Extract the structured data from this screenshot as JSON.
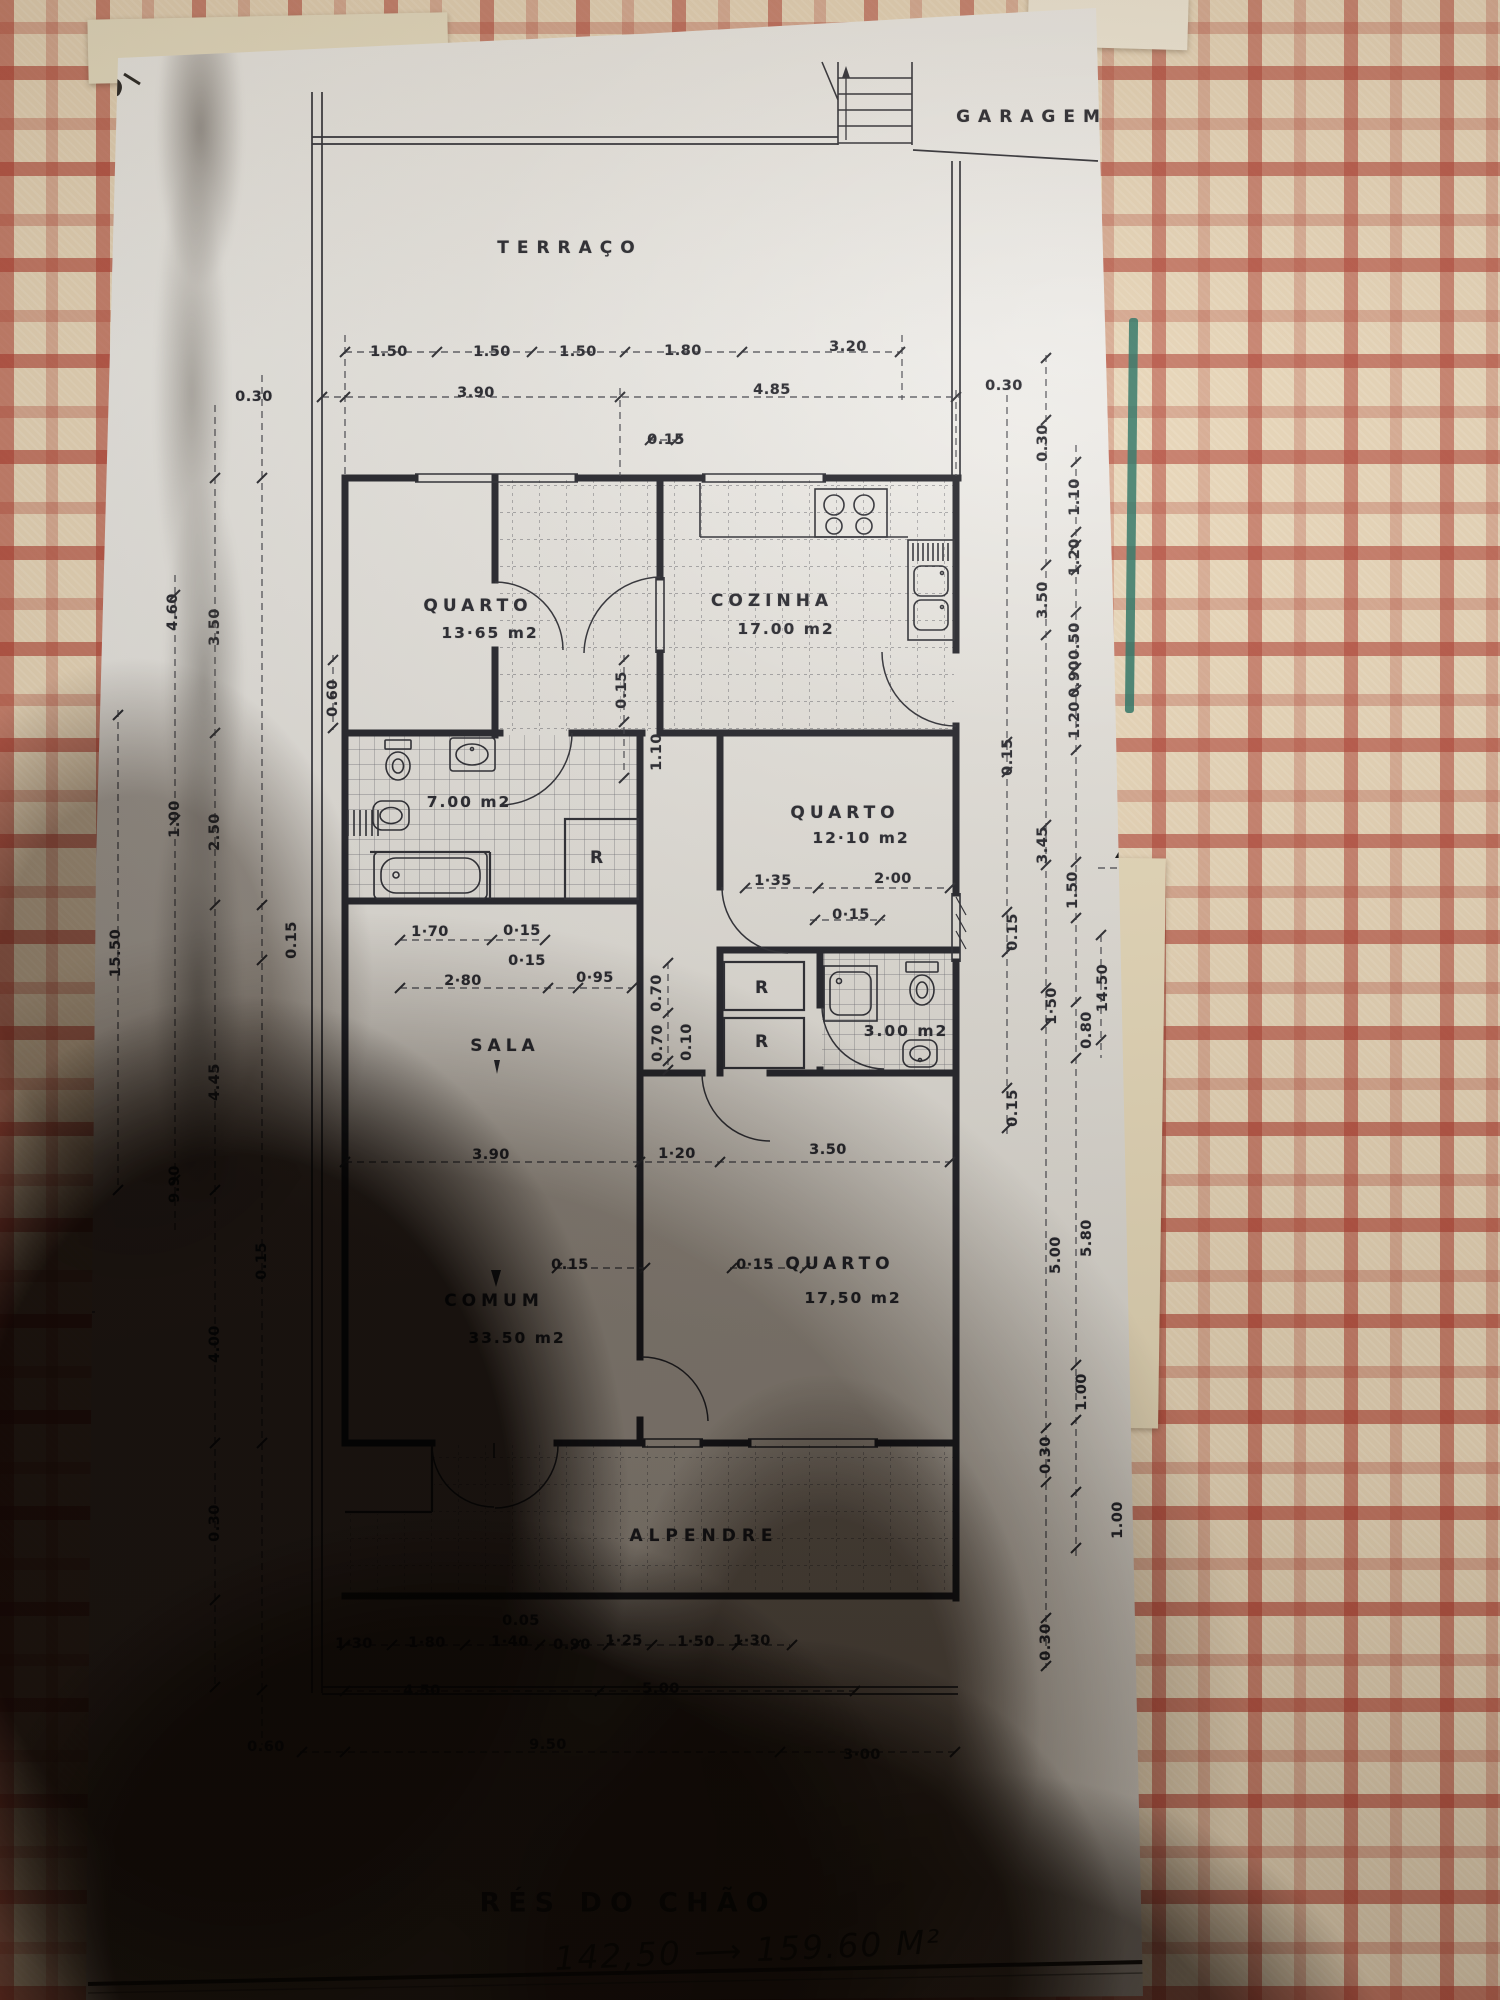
{
  "title_block": {
    "floor_label": "RÉS  DO CHÃO",
    "handwritten_note": "142,50 ⟶ 159.60 M²"
  },
  "plan": {
    "labels": [
      {
        "name": "garage-label",
        "text": "GARAGEM",
        "x": 1032,
        "y": 117,
        "cls": "room",
        "ls": 8
      },
      {
        "name": "terrace-label",
        "text": "TERRAÇO",
        "x": 570,
        "y": 248,
        "cls": "room",
        "ls": 8
      },
      {
        "name": "dim",
        "text": "1.50",
        "x": 389,
        "y": 352
      },
      {
        "name": "dim",
        "text": "1.50",
        "x": 492,
        "y": 352
      },
      {
        "name": "dim",
        "text": "1.50",
        "x": 578,
        "y": 352
      },
      {
        "name": "dim",
        "text": "1.80",
        "x": 683,
        "y": 351
      },
      {
        "name": "dim",
        "text": "3.20",
        "x": 848,
        "y": 347
      },
      {
        "name": "dim",
        "text": "0.30",
        "x": 254,
        "y": 397
      },
      {
        "name": "dim",
        "text": "3.90",
        "x": 476,
        "y": 393
      },
      {
        "name": "dim",
        "text": "4.85",
        "x": 772,
        "y": 390
      },
      {
        "name": "dim",
        "text": "0.30",
        "x": 1004,
        "y": 386
      },
      {
        "name": "dim",
        "text": "0.15",
        "x": 666,
        "y": 440
      },
      {
        "name": "room-label-quarto-1",
        "text": "QUARTO",
        "x": 478,
        "y": 606,
        "cls": "room"
      },
      {
        "name": "room-area-quarto-1",
        "text": "13·65 m2",
        "x": 490,
        "y": 633,
        "cls": "area"
      },
      {
        "name": "room-label-cozinha",
        "text": "COZINHA",
        "x": 772,
        "y": 601,
        "cls": "room"
      },
      {
        "name": "room-area-cozinha",
        "text": "17.00 m2",
        "x": 786,
        "y": 629,
        "cls": "area"
      },
      {
        "name": "dim",
        "text": "0.60",
        "x": 333,
        "y": 698,
        "rot": -90
      },
      {
        "name": "dim",
        "text": "0.15",
        "x": 622,
        "y": 690,
        "rot": -90
      },
      {
        "name": "dim",
        "text": "1.10",
        "x": 657,
        "y": 752,
        "rot": -90
      },
      {
        "name": "room-area-banho",
        "text": "7.00 m2",
        "x": 469,
        "y": 802,
        "cls": "area"
      },
      {
        "name": "room-label-quarto-2",
        "text": "QUARTO",
        "x": 845,
        "y": 813,
        "cls": "room"
      },
      {
        "name": "room-area-quarto-2",
        "text": "12·10 m2",
        "x": 861,
        "y": 838,
        "cls": "area"
      },
      {
        "name": "closet-label-r1",
        "text": "R",
        "x": 599,
        "y": 858,
        "cls": "room"
      },
      {
        "name": "dim",
        "text": "1·70",
        "x": 430,
        "y": 932
      },
      {
        "name": "dim",
        "text": "0·15",
        "x": 522,
        "y": 931
      },
      {
        "name": "dim",
        "text": "0·15",
        "x": 527,
        "y": 961
      },
      {
        "name": "dim",
        "text": "2·80",
        "x": 463,
        "y": 981
      },
      {
        "name": "dim",
        "text": "0·95",
        "x": 595,
        "y": 978
      },
      {
        "name": "dim",
        "text": "1·35",
        "x": 773,
        "y": 881
      },
      {
        "name": "dim",
        "text": "2·00",
        "x": 893,
        "y": 879
      },
      {
        "name": "dim",
        "text": "0·15",
        "x": 851,
        "y": 915
      },
      {
        "name": "dim",
        "text": "0.15",
        "x": 1013,
        "y": 932,
        "rot": -90
      },
      {
        "name": "dim",
        "text": "1·50",
        "x": 1052,
        "y": 1006,
        "rot": -90
      },
      {
        "name": "closet-label-r2",
        "text": "R",
        "x": 764,
        "y": 988,
        "cls": "room"
      },
      {
        "name": "closet-label-r3",
        "text": "R",
        "x": 764,
        "y": 1042,
        "cls": "room"
      },
      {
        "name": "room-area-wc",
        "text": "3.00 m2",
        "x": 906,
        "y": 1031,
        "cls": "area"
      },
      {
        "name": "dim",
        "text": "0.70",
        "x": 657,
        "y": 993,
        "rot": -90
      },
      {
        "name": "dim",
        "text": "0.70",
        "x": 658,
        "y": 1043,
        "rot": -90
      },
      {
        "name": "dim",
        "text": "0.10",
        "x": 687,
        "y": 1042,
        "rot": -90
      },
      {
        "name": "room-label-sala",
        "text": "SALA",
        "x": 505,
        "y": 1046,
        "cls": "room"
      },
      {
        "name": "dim",
        "text": "0.15",
        "x": 1013,
        "y": 1108,
        "rot": -90
      },
      {
        "name": "dim",
        "text": "3.90",
        "x": 491,
        "y": 1155
      },
      {
        "name": "dim",
        "text": "1·20",
        "x": 677,
        "y": 1154
      },
      {
        "name": "dim",
        "text": "3.50",
        "x": 828,
        "y": 1150
      },
      {
        "name": "dim",
        "text": "0.15",
        "x": 570,
        "y": 1265
      },
      {
        "name": "dim",
        "text": "0·15",
        "x": 755,
        "y": 1265
      },
      {
        "name": "room-label-quarto-3",
        "text": "QUARTO",
        "x": 840,
        "y": 1264,
        "cls": "room"
      },
      {
        "name": "room-area-quarto-3",
        "text": "17,50 m2",
        "x": 853,
        "y": 1298,
        "cls": "area"
      },
      {
        "name": "room-label-comum",
        "text": "COMUM",
        "x": 494,
        "y": 1301,
        "cls": "room"
      },
      {
        "name": "room-area-comum",
        "text": "33.50 m2",
        "x": 517,
        "y": 1338,
        "cls": "area"
      },
      {
        "name": "porch-label",
        "text": "ALPENDRE",
        "x": 704,
        "y": 1536,
        "cls": "room",
        "ls": 6
      },
      {
        "name": "dim",
        "text": "0.05",
        "x": 521,
        "y": 1621
      },
      {
        "name": "dim",
        "text": "1·30",
        "x": 354,
        "y": 1644
      },
      {
        "name": "dim",
        "text": "1·80",
        "x": 427,
        "y": 1643
      },
      {
        "name": "dim",
        "text": "1·40",
        "x": 510,
        "y": 1642
      },
      {
        "name": "dim",
        "text": "0.90",
        "x": 572,
        "y": 1645
      },
      {
        "name": "dim",
        "text": "1·25",
        "x": 624,
        "y": 1641
      },
      {
        "name": "dim",
        "text": "1·50",
        "x": 696,
        "y": 1642
      },
      {
        "name": "dim",
        "text": "1·30",
        "x": 752,
        "y": 1641
      },
      {
        "name": "dim",
        "text": "4.50",
        "x": 422,
        "y": 1691
      },
      {
        "name": "dim",
        "text": "5.00",
        "x": 661,
        "y": 1689
      },
      {
        "name": "dim",
        "text": "0.60",
        "x": 266,
        "y": 1747
      },
      {
        "name": "dim",
        "text": "9.50",
        "x": 548,
        "y": 1745
      },
      {
        "name": "dim",
        "text": "3·00",
        "x": 862,
        "y": 1755
      },
      {
        "name": "dim",
        "text": "4.60",
        "x": 173,
        "y": 612,
        "rot": -90
      },
      {
        "name": "dim",
        "text": "3.50",
        "x": 215,
        "y": 627,
        "rot": -90
      },
      {
        "name": "dim",
        "text": "1.00",
        "x": 175,
        "y": 819,
        "rot": -90
      },
      {
        "name": "dim",
        "text": "2.50",
        "x": 215,
        "y": 832,
        "rot": -90
      },
      {
        "name": "dim",
        "text": "0.15",
        "x": 292,
        "y": 940,
        "rot": -90
      },
      {
        "name": "dim",
        "text": "15.50",
        "x": 116,
        "y": 953,
        "rot": -90
      },
      {
        "name": "dim",
        "text": "4.45",
        "x": 215,
        "y": 1082,
        "rot": -90
      },
      {
        "name": "dim",
        "text": "9.90",
        "x": 175,
        "y": 1184,
        "rot": -90
      },
      {
        "name": "dim",
        "text": "0.15",
        "x": 262,
        "y": 1261,
        "rot": -90
      },
      {
        "name": "dim",
        "text": "4.00",
        "x": 215,
        "y": 1344,
        "rot": -90
      },
      {
        "name": "dim",
        "text": "0.30",
        "x": 215,
        "y": 1523,
        "rot": -90
      },
      {
        "name": "dim",
        "text": "0.30",
        "x": 1043,
        "y": 443,
        "rot": -90
      },
      {
        "name": "dim",
        "text": "1.10",
        "x": 1075,
        "y": 497,
        "rot": -90
      },
      {
        "name": "dim",
        "text": "1.20",
        "x": 1075,
        "y": 557,
        "rot": -90
      },
      {
        "name": "dim",
        "text": "3.50",
        "x": 1043,
        "y": 600,
        "rot": -90
      },
      {
        "name": "dim",
        "text": "0.50",
        "x": 1075,
        "y": 641,
        "rot": -90
      },
      {
        "name": "dim",
        "text": "0.90",
        "x": 1075,
        "y": 679,
        "rot": -90
      },
      {
        "name": "dim",
        "text": "1.20",
        "x": 1075,
        "y": 720,
        "rot": -90
      },
      {
        "name": "dim",
        "text": "0.15",
        "x": 1008,
        "y": 757,
        "rot": -90
      },
      {
        "name": "dim",
        "text": "3.45",
        "x": 1043,
        "y": 845,
        "rot": -90
      },
      {
        "name": "dim",
        "text": "1.50",
        "x": 1073,
        "y": 890,
        "rot": -90
      },
      {
        "name": "dim",
        "text": "0.80",
        "x": 1087,
        "y": 1030,
        "rot": -90
      },
      {
        "name": "dim",
        "text": "5.00",
        "x": 1056,
        "y": 1255,
        "rot": -90
      },
      {
        "name": "dim",
        "text": "5.80",
        "x": 1087,
        "y": 1238,
        "rot": -90
      },
      {
        "name": "dim",
        "text": "14.50",
        "x": 1103,
        "y": 988,
        "rot": -90
      },
      {
        "name": "serventia-label",
        "text": "SERVENTIA",
        "x": 1134,
        "y": 1088,
        "rot": -90,
        "cls": "room",
        "ls": 3
      },
      {
        "name": "dim",
        "text": "1.00",
        "x": 1082,
        "y": 1392,
        "rot": -90
      },
      {
        "name": "dim",
        "text": "0.30",
        "x": 1046,
        "y": 1455,
        "rot": -90
      },
      {
        "name": "dim",
        "text": "1.00",
        "x": 1118,
        "y": 1520,
        "rot": -90
      },
      {
        "name": "dim",
        "text": "0.30",
        "x": 1046,
        "y": 1642,
        "rot": -90
      },
      {
        "name": "section-marker-c",
        "text": "C",
        "x": 43,
        "y": 1333,
        "cls": "marker"
      },
      {
        "name": "section-marker-d",
        "text": "D",
        "x": 1128,
        "y": 888,
        "cls": "marker"
      }
    ]
  }
}
